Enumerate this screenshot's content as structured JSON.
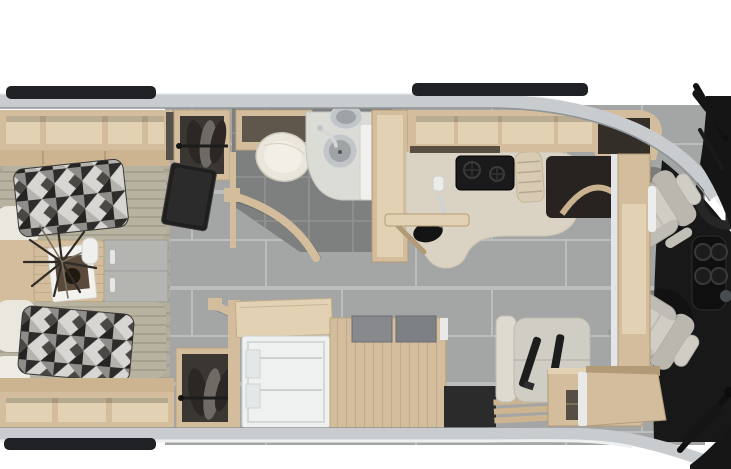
{
  "scene": {
    "title": "Top-down 3D rendered floor plan of a motorhome RV: rear twin bedroom at left, mid bathroom and galley kitchen, belted dinette bench, and driver cab with swivel seats at right"
  },
  "colors": {
    "wood": "#d3bd9c",
    "wood_light": "#e2d2b3",
    "wood_dark": "#b19a75",
    "wood_face": "#cbb48f",
    "carpet": "#b2ad9b",
    "bed": "#b8b3a1",
    "pillow_white": "#eae7df",
    "tile_hall": "#a4a5a5",
    "tile_grout": "#bcbdbd",
    "tile_bath": "#7e7f7f",
    "tile_bath_grout": "#919292",
    "counter": "#dad3c3",
    "seat": "#d0cdc5",
    "seat_shadow": "#bab7af",
    "bench": "#dedacf",
    "fridge_white": "#eff1f1",
    "toilet_white": "#eae6db",
    "steel": "#c3c6c8",
    "chrome": "#d7d9da",
    "dash_black": "#181818",
    "rail_black": "#202124",
    "band_gray": "#c9cccf",
    "band_edge": "#8f9598",
    "garment_dark": "#2a2724"
  },
  "areas": {
    "bedroom": {
      "name": "rear-twin-bedroom",
      "items": [
        "overhead-cubbies",
        "twin-bed-top",
        "twin-bed-bottom",
        "geometric-pillow-top",
        "geometric-pillow-bottom",
        "white-pillows",
        "nightstand",
        "potted-plant",
        "magazine",
        "drawer-unit",
        "wardrobe-top",
        "wardrobe-bottom",
        "tv-panel",
        "foot-storage-cubbies"
      ]
    },
    "bathroom": {
      "name": "bathroom",
      "items": [
        "toilet",
        "toilet-shelf",
        "vanity-counter",
        "round-sink-bowls",
        "bath-faucet",
        "shower-panel",
        "curved-door-upper",
        "curved-door-lower"
      ]
    },
    "galley": {
      "name": "kitchen-galley",
      "items": [
        "partition-wall",
        "flip-up-counter-extension",
        "kitchen-counter",
        "kitchen-sink",
        "kitchen-faucet",
        "soap-dispenser",
        "two-burner-cooktop",
        "dish-towel",
        "overhead-cabinets",
        "refrigerator",
        "counter-flap",
        "island-cabinet",
        "island-top-panels",
        "entry-step",
        "entry-well"
      ]
    },
    "lounge": {
      "name": "dinette-lounge",
      "items": [
        "belted-bench-seat",
        "seatbelts",
        "side-cabinet"
      ]
    },
    "cab": {
      "name": "driver-cab",
      "items": [
        "driver-seat",
        "passenger-seat",
        "steering-wheel",
        "center-console-cupholders",
        "dashboard",
        "cab-overhead-cabinet-top",
        "cab-overhead-cabinet-bottom",
        "cab-pillar-trim",
        "windshield-wiper-top",
        "windshield-wiper-bottom"
      ]
    },
    "exterior": {
      "name": "exterior-body",
      "items": [
        "body-sidewall-top",
        "body-sidewall-bottom",
        "awning-rail-top-rear",
        "awning-rail-top-front",
        "awning-rail-bottom"
      ]
    }
  }
}
